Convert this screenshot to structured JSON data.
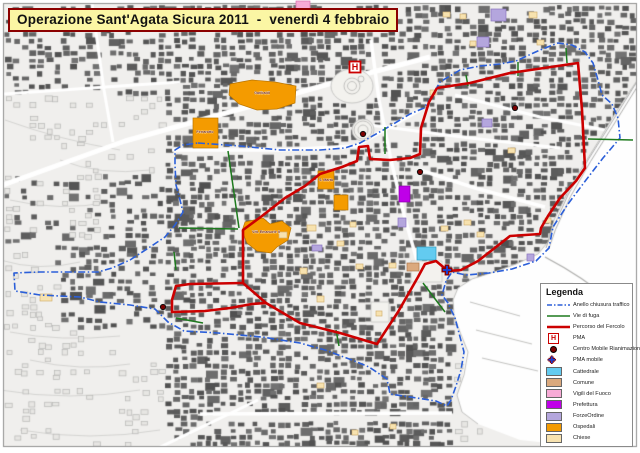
{
  "title": {
    "text": "Operazione Sant'Agata Sicura 2011  -  venerdì 4 febbraio"
  },
  "colors": {
    "title_bg": "#fbf6a4",
    "title_border": "#8b0000",
    "percorso": "#cc0000",
    "anello": "#2b5fd9",
    "vie_di_fuga": "#1e7a1e",
    "pma": "#cc0000",
    "centro_mobile": "#7d0000",
    "pma_mobile": "#1b3fd0",
    "cattedrale": "#63cbf0",
    "comune": "#dba97d",
    "vigili_fuoco": "#f7aad6",
    "prefettura": "#bf00e8",
    "forze_ordine": "#b4a6dd",
    "ospedali": "#f49b00",
    "chiese": "#f7e2af"
  },
  "legend": {
    "title": "Legenda",
    "items": [
      {
        "type": "line-dashdot",
        "color_key": "anello",
        "label": "Anello chiusura traffico"
      },
      {
        "type": "line",
        "color_key": "vie_di_fuga",
        "label": "Vie di fuga"
      },
      {
        "type": "line-thick",
        "color_key": "percorso",
        "label": "Percorso del Fercolo"
      },
      {
        "type": "pma",
        "color_key": "pma",
        "label": "PMA"
      },
      {
        "type": "dot",
        "color_key": "centro_mobile",
        "label": "Centro Mobile Rianimazione"
      },
      {
        "type": "cross",
        "color_key": "pma_mobile",
        "label": "PMA mobile"
      },
      {
        "type": "swatch",
        "color_key": "cattedrale",
        "label": "Cattedrale"
      },
      {
        "type": "swatch",
        "color_key": "comune",
        "label": "Comune"
      },
      {
        "type": "swatch",
        "color_key": "vigili_fuoco",
        "label": "Vigili del Fuoco"
      },
      {
        "type": "swatch",
        "color_key": "prefettura",
        "label": "Prefettura"
      },
      {
        "type": "swatch",
        "color_key": "forze_ordine",
        "label": "ForzeOrdine"
      },
      {
        "type": "swatch",
        "color_key": "ospedali",
        "label": "Ospedali"
      },
      {
        "type": "swatch",
        "color_key": "chiese",
        "label": "Chiese"
      }
    ]
  },
  "map": {
    "routes": {
      "percorso": {
        "width": 2.6,
        "main": [
          [
            437,
            88
          ],
          [
            470,
            83
          ],
          [
            510,
            73
          ],
          [
            578,
            63
          ],
          [
            582,
            110
          ],
          [
            585,
            168
          ],
          [
            576,
            181
          ],
          [
            560,
            198
          ],
          [
            548,
            216
          ],
          [
            541,
            228
          ],
          [
            540,
            234
          ],
          [
            510,
            236
          ],
          [
            496,
            247
          ],
          [
            478,
            261
          ],
          [
            461,
            270
          ],
          [
            448,
            271
          ],
          [
            436,
            261
          ],
          [
            425,
            264
          ],
          [
            418,
            277
          ],
          [
            398,
            312
          ],
          [
            377,
            344
          ],
          [
            340,
            333
          ],
          [
            300,
            323
          ],
          [
            266,
            303
          ],
          [
            243,
            283
          ],
          [
            243,
            230
          ],
          [
            262,
            216
          ],
          [
            285,
            198
          ],
          [
            305,
            186
          ],
          [
            320,
            174
          ],
          [
            342,
            167
          ],
          [
            357,
            161
          ],
          [
            359,
            147
          ],
          [
            368,
            146
          ],
          [
            370,
            159
          ],
          [
            390,
            160
          ],
          [
            410,
            158
          ],
          [
            420,
            154
          ],
          [
            421,
            128
          ],
          [
            429,
            102
          ],
          [
            437,
            88
          ]
        ],
        "west_loop": [
          [
            243,
            283
          ],
          [
            190,
            284
          ],
          [
            176,
            286
          ],
          [
            172,
            300
          ],
          [
            172,
            312
          ],
          [
            205,
            311
          ],
          [
            230,
            308
          ],
          [
            252,
            304
          ],
          [
            266,
            303
          ]
        ]
      },
      "anello": {
        "width": 1.6,
        "points": [
          [
            198,
            143
          ],
          [
            240,
            146
          ],
          [
            280,
            150
          ],
          [
            320,
            150
          ],
          [
            345,
            148
          ],
          [
            360,
            143
          ],
          [
            385,
            129
          ],
          [
            410,
            114
          ],
          [
            424,
            108
          ],
          [
            432,
            96
          ],
          [
            440,
            82
          ],
          [
            460,
            70
          ],
          [
            480,
            66
          ],
          [
            500,
            64
          ],
          [
            516,
            61
          ],
          [
            540,
            50
          ],
          [
            558,
            43
          ],
          [
            572,
            45
          ],
          [
            585,
            52
          ],
          [
            593,
            63
          ],
          [
            598,
            80
          ],
          [
            602,
            95
          ],
          [
            612,
            104
          ],
          [
            618,
            118
          ],
          [
            620,
            138
          ],
          [
            603,
            158
          ],
          [
            586,
            180
          ],
          [
            568,
            204
          ],
          [
            553,
            227
          ],
          [
            549,
            248
          ],
          [
            536,
            261
          ],
          [
            512,
            269
          ],
          [
            489,
            273
          ],
          [
            466,
            275
          ],
          [
            452,
            272
          ],
          [
            446,
            281
          ],
          [
            442,
            295
          ],
          [
            448,
            303
          ],
          [
            455,
            318
          ],
          [
            459,
            333
          ],
          [
            464,
            352
          ],
          [
            461,
            370
          ],
          [
            456,
            386
          ],
          [
            451,
            400
          ],
          [
            447,
            406
          ],
          [
            436,
            401
          ],
          [
            410,
            397
          ],
          [
            390,
            394
          ],
          [
            387,
            379
          ],
          [
            369,
            367
          ],
          [
            352,
            360
          ],
          [
            325,
            350
          ],
          [
            300,
            343
          ],
          [
            262,
            337
          ],
          [
            218,
            333
          ],
          [
            184,
            331
          ],
          [
            168,
            322
          ],
          [
            155,
            309
          ],
          [
            130,
            305
          ],
          [
            100,
            302
          ],
          [
            80,
            297
          ],
          [
            40,
            295
          ],
          [
            15,
            291
          ],
          [
            14,
            273
          ],
          [
            40,
            272
          ],
          [
            70,
            272
          ],
          [
            98,
            272
          ],
          [
            112,
            268
          ],
          [
            130,
            260
          ],
          [
            150,
            247
          ],
          [
            165,
            237
          ],
          [
            175,
            225
          ],
          [
            183,
            212
          ],
          [
            180,
            200
          ],
          [
            176,
            185
          ],
          [
            175,
            165
          ],
          [
            175,
            150
          ],
          [
            183,
            145
          ],
          [
            198,
            143
          ]
        ]
      },
      "vie_di_fuga": [
        [
          228,
          151,
          239,
          228
        ],
        [
          179,
          228,
          238,
          229
        ],
        [
          385,
          127,
          385,
          154
        ],
        [
          466,
          75,
          468,
          86
        ],
        [
          518,
          62,
          518,
          76
        ],
        [
          566,
          48,
          567,
          63
        ],
        [
          588,
          139,
          633,
          140
        ],
        [
          423,
          283,
          445,
          312
        ],
        [
          336,
          330,
          339,
          346
        ],
        [
          176,
          318,
          203,
          323
        ],
        [
          174,
          252,
          176,
          270
        ]
      ]
    },
    "markers": {
      "pma": [
        [
          355,
          67
        ]
      ],
      "centro_mobile": [
        [
          363,
          134
        ],
        [
          420,
          172
        ],
        [
          515,
          108
        ],
        [
          163,
          307
        ]
      ],
      "pma_mobile": [
        [
          447,
          270
        ]
      ]
    },
    "areas": [
      {
        "cat": "ospedali",
        "poly": [
          [
            230,
            84
          ],
          [
            252,
            80
          ],
          [
            275,
            82
          ],
          [
            296,
            86
          ],
          [
            295,
            103
          ],
          [
            277,
            109
          ],
          [
            257,
            110
          ],
          [
            239,
            104
          ],
          [
            229,
            95
          ]
        ]
      },
      {
        "cat": "ospedali",
        "rect": [
          193,
          118,
          25,
          30
        ]
      },
      {
        "cat": "ospedali",
        "poly": [
          [
            245,
            222
          ],
          [
            263,
            218
          ],
          [
            270,
            224
          ],
          [
            282,
            221
          ],
          [
            291,
            228
          ],
          [
            288,
            240
          ],
          [
            277,
            247
          ],
          [
            271,
            253
          ],
          [
            257,
            251
          ],
          [
            247,
            243
          ],
          [
            242,
            231
          ]
        ]
      },
      {
        "cat": "ospedali",
        "rect": [
          318,
          171,
          16,
          18
        ]
      },
      {
        "cat": "ospedali",
        "rect": [
          334,
          195,
          14,
          15
        ]
      },
      {
        "cat": "cattedrale",
        "rect": [
          417,
          247,
          19,
          13
        ]
      },
      {
        "cat": "comune",
        "rect": [
          407,
          263,
          12,
          8
        ]
      },
      {
        "cat": "prefettura",
        "rect": [
          399,
          186,
          11,
          16
        ]
      },
      {
        "cat": "vigili_fuoco",
        "rect": [
          296,
          1,
          14,
          9
        ]
      },
      {
        "cat": "forze_ordine",
        "rect": [
          491,
          9,
          15,
          12
        ]
      },
      {
        "cat": "forze_ordine",
        "rect": [
          477,
          37,
          12,
          10
        ]
      },
      {
        "cat": "forze_ordine",
        "rect": [
          482,
          119,
          10,
          8
        ]
      },
      {
        "cat": "forze_ordine",
        "rect": [
          398,
          218,
          8,
          9
        ]
      },
      {
        "cat": "forze_ordine",
        "rect": [
          312,
          245,
          10,
          6
        ]
      },
      {
        "cat": "forze_ordine",
        "rect": [
          527,
          254,
          7,
          7
        ]
      },
      {
        "cat": "chiese",
        "rect": [
          279,
          232,
          8,
          6
        ]
      },
      {
        "cat": "chiese",
        "rect": [
          307,
          225,
          9,
          6
        ]
      },
      {
        "cat": "chiese",
        "rect": [
          300,
          268,
          7,
          6
        ]
      },
      {
        "cat": "chiese",
        "rect": [
          317,
          296,
          7,
          6
        ]
      },
      {
        "cat": "chiese",
        "rect": [
          337,
          241,
          7,
          5
        ]
      },
      {
        "cat": "chiese",
        "rect": [
          356,
          264,
          7,
          5
        ]
      },
      {
        "cat": "chiese",
        "rect": [
          389,
          263,
          7,
          5
        ]
      },
      {
        "cat": "chiese",
        "rect": [
          376,
          311,
          6,
          5
        ]
      },
      {
        "cat": "chiese",
        "rect": [
          441,
          226,
          7,
          5
        ]
      },
      {
        "cat": "chiese",
        "rect": [
          464,
          220,
          7,
          5
        ]
      },
      {
        "cat": "chiese",
        "rect": [
          477,
          232,
          7,
          5
        ]
      },
      {
        "cat": "chiese",
        "rect": [
          529,
          12,
          8,
          6
        ]
      },
      {
        "cat": "chiese",
        "rect": [
          537,
          40,
          7,
          5
        ]
      },
      {
        "cat": "chiese",
        "rect": [
          443,
          12,
          7,
          5
        ]
      },
      {
        "cat": "chiese",
        "rect": [
          470,
          41,
          6,
          5
        ]
      },
      {
        "cat": "chiese",
        "rect": [
          508,
          148,
          7,
          5
        ]
      },
      {
        "cat": "chiese",
        "rect": [
          430,
          90,
          6,
          5
        ]
      },
      {
        "cat": "chiese",
        "rect": [
          350,
          222,
          6,
          5
        ]
      },
      {
        "cat": "chiese",
        "rect": [
          317,
          383,
          7,
          5
        ]
      },
      {
        "cat": "chiese",
        "rect": [
          352,
          430,
          6,
          5
        ]
      },
      {
        "cat": "chiese",
        "rect": [
          390,
          424,
          6,
          5
        ]
      },
      {
        "cat": "chiese",
        "rect": [
          40,
          294,
          12,
          7
        ]
      },
      {
        "cat": "chiese",
        "rect": [
          545,
          218,
          6,
          5
        ]
      },
      {
        "cat": "chiese",
        "rect": [
          460,
          14,
          6,
          5
        ]
      }
    ],
    "area_labels": [
      {
        "text": "Garibaldi",
        "x": 262,
        "y": 94
      },
      {
        "text": "Ferrarotto",
        "x": 205,
        "y": 133
      },
      {
        "text": "S. Marta",
        "x": 326,
        "y": 181
      },
      {
        "text": "Vitt. Emanuele II",
        "x": 266,
        "y": 233
      }
    ]
  }
}
